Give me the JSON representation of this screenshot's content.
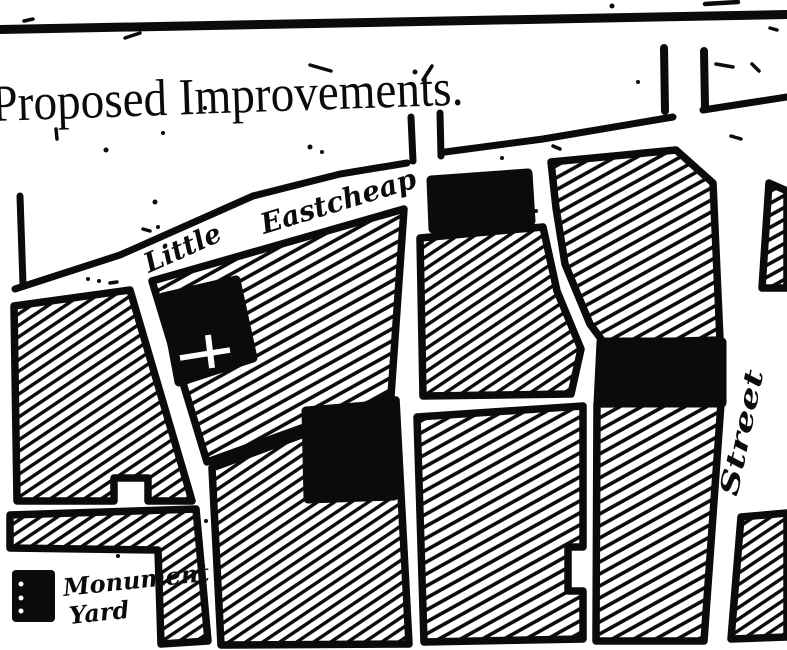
{
  "colors": {
    "ink": "#0b0b0b",
    "paper": "#ffffff"
  },
  "title": {
    "text": "Proposed Improvements."
  },
  "streets": {
    "little": "Little",
    "eastcheap": "Eastcheap",
    "vertical_street": "Street"
  },
  "legend": {
    "swatch_color": "#0b0b0b",
    "label_line1": "Monument",
    "label_line2": "Yard"
  }
}
